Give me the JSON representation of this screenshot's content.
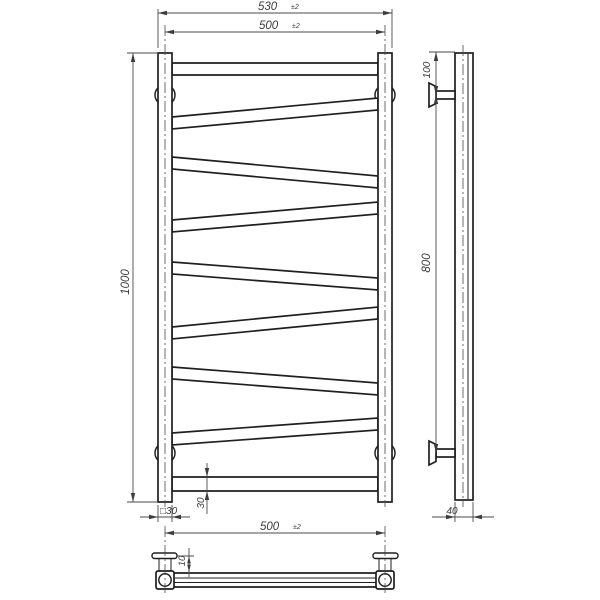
{
  "drawing": {
    "type": "technical-drawing",
    "subject": "zigzag towel rail ladder — front, side and top orthographic views",
    "dimensions": {
      "front": {
        "overall_width": {
          "value": "530",
          "tolerance": "±2"
        },
        "axis_width": {
          "value": "500",
          "tolerance": "±2"
        },
        "height": {
          "value": "1000"
        },
        "post_section": {
          "value": "□30"
        },
        "tube_diameter": {
          "value": "30"
        }
      },
      "side": {
        "top_to_bracket": {
          "value": "100"
        },
        "bracket_spacing": {
          "value": "800"
        },
        "depth": {
          "value": "40"
        }
      },
      "top_view": {
        "axis_width": {
          "value": "500",
          "tolerance": "±2"
        },
        "flange_offset": {
          "value": "10"
        }
      }
    }
  }
}
